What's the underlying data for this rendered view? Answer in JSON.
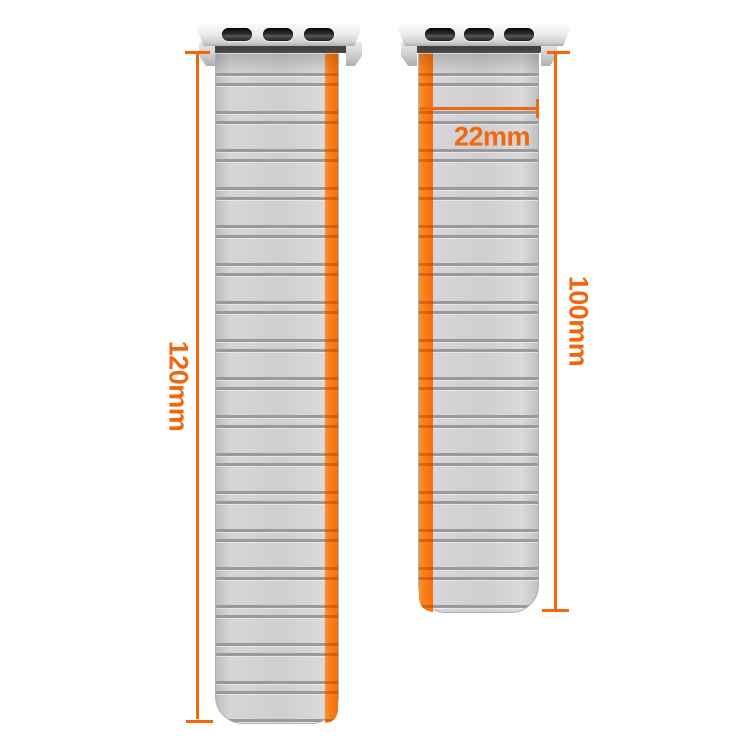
{
  "diagram": {
    "left_band": {
      "length_label": "120mm"
    },
    "right_band": {
      "length_label": "100mm",
      "width_label": "22mm"
    },
    "colors": {
      "accent_orange": "#f3660b",
      "stripe_orange": "#f8801a",
      "strap_gray": "#d2d2d4",
      "ridge_gray": "#9a9a9c",
      "connector_silver": "#ececee",
      "slot_black": "#2b2b2d"
    }
  }
}
